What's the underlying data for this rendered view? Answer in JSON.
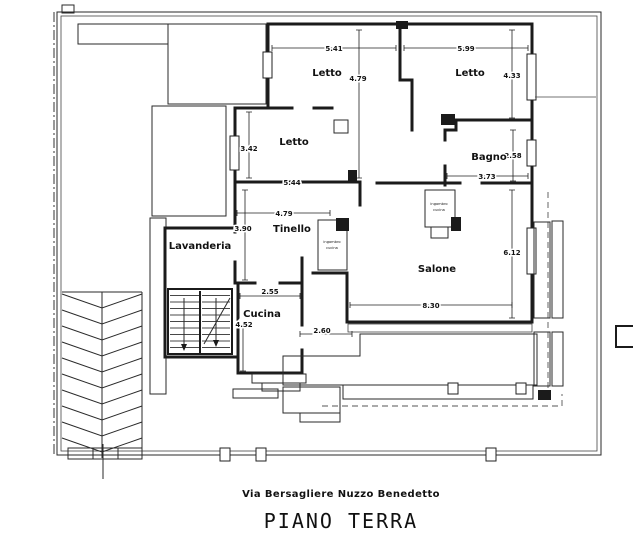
{
  "meta": {
    "address": "Via Bersagliere Nuzzo Benedetto",
    "title": "PIANO TERRA"
  },
  "rooms": {
    "letto_top_mid": "Letto",
    "letto_top_right": "Letto",
    "letto_mid_left": "Letto",
    "bagno": "Bagno",
    "tinello": "Tinello",
    "lavanderia": "Lavanderia",
    "cucina": "Cucina",
    "salone": "Salone"
  },
  "dims": {
    "letto_top_mid_w": "5.41",
    "letto_top_mid_h": "4.79",
    "letto_top_right_w": "5.99",
    "letto_top_right_h": "4.33",
    "letto_mid_left_h": "3.42",
    "letto_mid_left_w": "5.44",
    "bagno_h": "2.58",
    "bagno_w": "3.73",
    "tinello_w": "4.79",
    "tinello_h": "3.90",
    "cucina_w": "2.55",
    "cucina_h": "4.52",
    "terrace_w": "2.60",
    "salone_h": "6.12",
    "salone_w": "8.30"
  },
  "annotations": {
    "closet1_line1": "ingombro",
    "closet1_line2": "cucina",
    "closet2_line1": "ingombro",
    "closet2_line2": "cucina"
  },
  "colors": {
    "ink": "#1b1b1b",
    "paper": "#ffffff"
  }
}
